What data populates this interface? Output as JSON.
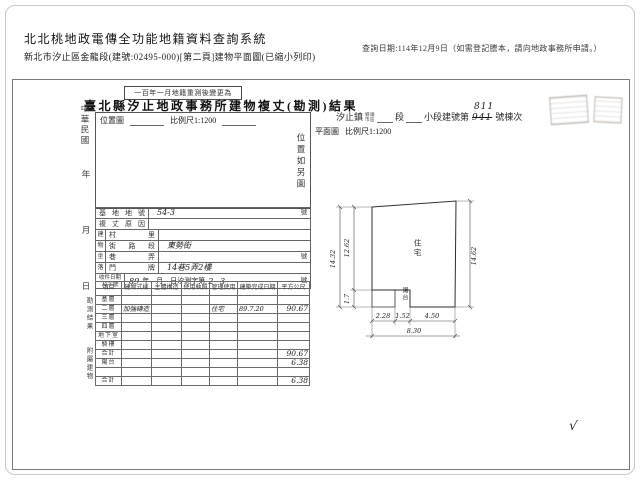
{
  "header": {
    "system_title": "北北桃地政電傳全功能地籍資料查詢系統",
    "query_date": "查詢日期:114年12月9日（如需登記謄本，請向地政事務所申請。）",
    "subtitle": "新北市汐止區金龍段(建號:02495-000)[第二頁]建物平面圖(已縮小列印)"
  },
  "doc": {
    "note": "一百年一月地籍重測後變更為",
    "title": "臺北縣汐止地政事務所建物複丈(勘測)結果",
    "strip": {
      "era": "中華民國",
      "year": "年",
      "month": "月",
      "day": "日",
      "group1": "勘測結果",
      "group2": "附屬建物"
    },
    "location": {
      "label": "位置圖",
      "scale": "比例尺1:1200",
      "note": "位置如另圖"
    },
    "site": {
      "town": "汐止鎮",
      "unit_top": "鄉鎮",
      "unit_bottom": "市區",
      "seg": "段",
      "subseg": "小段建號第",
      "old_no": "941",
      "new_no": "811",
      "tail": "號棟次"
    },
    "plan_head": {
      "label": "平面圖",
      "scale": "比例尺1:1200"
    },
    "info_rows": [
      {
        "g": "",
        "label": "基地地號",
        "value": "54-3",
        "suffix": "號"
      },
      {
        "g": "",
        "label": "複丈原因",
        "value": "",
        "suffix": ""
      },
      {
        "g": "建",
        "label": "村里",
        "value": "",
        "suffix": ""
      },
      {
        "g": "物",
        "label": "街路段",
        "value": "東勢街",
        "suffix": ""
      },
      {
        "g": "坐",
        "label": "巷弄",
        "value": "",
        "suffix": "號"
      },
      {
        "g": "落",
        "label": "門牌",
        "value": "14巷5弄2樓",
        "suffix": ""
      }
    ],
    "receipt": {
      "label1": "收件日期",
      "label2": "及字號",
      "hand_year": "89",
      "pre": "年　月　日汐測字第",
      "hand_no": "2~3",
      "suffix": "號"
    },
    "measure": {
      "headers": [
        "項目",
        "建物式樣",
        "主體構造",
        "使用執照",
        "管理使用",
        "建築完成日期",
        "平方公尺"
      ],
      "rows": [
        [
          "基層",
          "",
          "",
          "",
          "",
          "",
          ""
        ],
        [
          "二層",
          "加強磚造",
          "",
          "",
          "住宅",
          "89.7.20",
          "90.67"
        ],
        [
          "三層",
          "",
          "",
          "",
          "",
          "",
          ""
        ],
        [
          "四層",
          "",
          "",
          "",
          "",
          "",
          ""
        ],
        [
          "地下室",
          "",
          "",
          "",
          "",
          "",
          ""
        ],
        [
          "騎樓",
          "",
          "",
          "",
          "",
          "",
          ""
        ],
        [
          "合計",
          "",
          "",
          "",
          "",
          "",
          "90.67"
        ],
        [
          "陽台",
          "",
          "",
          "",
          "",
          "",
          "6.38"
        ],
        [
          "",
          "",
          "",
          "",
          "",
          "",
          ""
        ],
        [
          "合計",
          "",
          "",
          "",
          "",
          "",
          "6.38"
        ]
      ]
    },
    "plan": {
      "room": "住宅",
      "balcony": "陽台",
      "dims": {
        "right": "14.62",
        "left_outer": "14.32",
        "left_inner": "12.62",
        "notch": "1.7",
        "b1": "2.28",
        "b2": "1.52",
        "b3": "4.50",
        "total": "8.30"
      },
      "check": "√"
    }
  }
}
